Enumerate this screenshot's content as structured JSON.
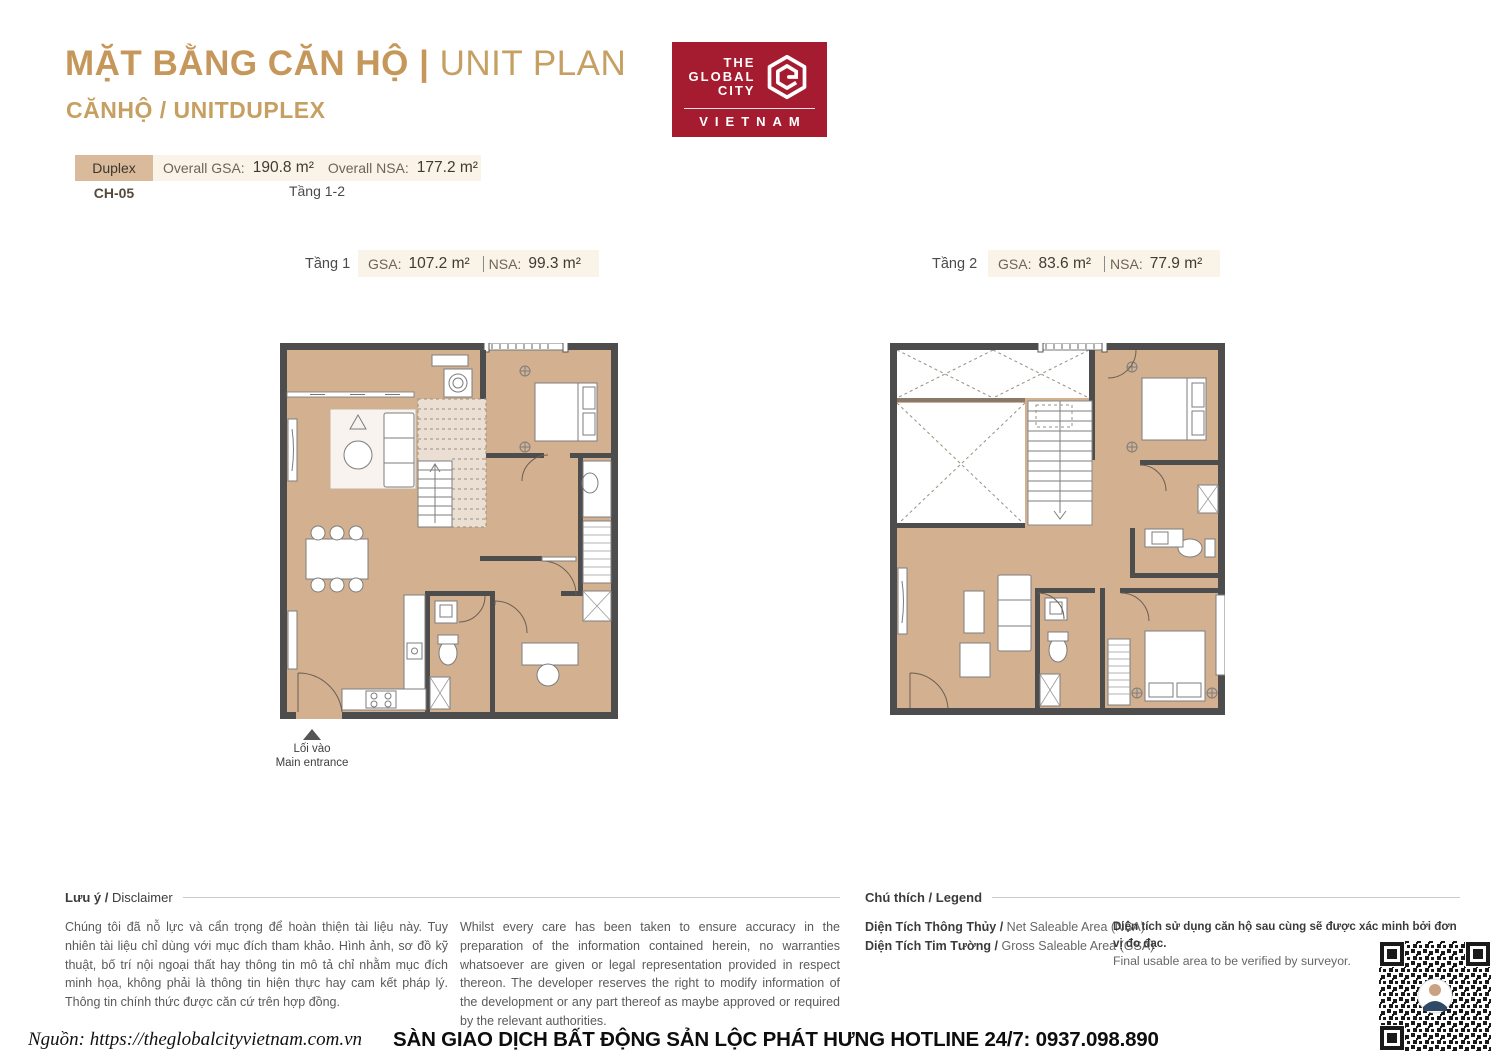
{
  "header": {
    "title_vi": "MẶT BẰNG CĂN HỘ |",
    "title_en": " UNIT PLAN",
    "subtitle": "CĂNHỘ / UNITDUPLEX",
    "logo": {
      "line1": "THE",
      "line2": "GLOBAL",
      "line3": "CITY",
      "country": "VIETNAM",
      "brand_color": "#A51C30"
    }
  },
  "summary": {
    "type_label": "Duplex",
    "gsa_label": "Overall GSA:",
    "gsa_value": "190.8 m²",
    "nsa_label": "Overall NSA:",
    "nsa_value": "177.2 m²",
    "unit_code": "CH-05",
    "floors_label": "Tầng 1-2"
  },
  "floors": [
    {
      "name": "Tầng 1",
      "gsa_label": "GSA:",
      "gsa_value": "107.2 m²",
      "nsa_label": "NSA:",
      "nsa_value": "99.3 m²"
    },
    {
      "name": "Tầng 2",
      "gsa_label": "GSA:",
      "gsa_value": "83.6 m²",
      "nsa_label": "NSA:",
      "nsa_value": "77.9 m²"
    }
  ],
  "entrance": {
    "line_vi": "Lối vào",
    "line_en": "Main entrance"
  },
  "disclaimer": {
    "heading_bold": "Lưu ý /",
    "heading_rest": " Disclaimer",
    "text_vi": "Chúng tôi đã nỗ lực và cẩn trọng để hoàn thiện tài liệu này. Tuy nhiên tài liệu chỉ dùng với mục đích tham khảo. Hình ảnh, sơ đồ kỹ thuật, bố trí nội ngoại thất hay thông tin mô tả chỉ nhằm mục đích minh họa, không phải là thông tin hiện thực hay cam kết pháp lý. Thông tin chính thức được căn cứ trên hợp đồng.",
    "text_en": "Whilst every care has been taken to ensure accuracy in the preparation of the information contained herein, no warranties whatsoever are given or legal representation provided in respect thereon. The developer reserves the right to modify information of the development or any part thereof as maybe approved or required by the relevant authorities."
  },
  "legend": {
    "heading_bold": "Chú thích /",
    "heading_rest": " Legend",
    "items": [
      {
        "vi": "Diện Tích Thông Thủy /",
        "en": " Net Saleable Area (NSA)"
      },
      {
        "vi": "Diện Tích Tim Tường /",
        "en": " Gross Saleable Area (GSA)"
      }
    ],
    "note_vi": "Diện tích sử dụng căn hộ sau cùng sẽ được xác minh bởi đơn vị đo đạc.",
    "note_en": "Final usable area to be verified by surveyor."
  },
  "footer": {
    "source": "Nguồn: https://theglobalcityvietnam.com.vn",
    "agency": "SÀN GIAO DỊCH BẤT ĐỘNG SẢN LỘC PHÁT HƯNG HOTLINE 24/7: 0937.098.890"
  },
  "colors": {
    "accent_gold": "#C6975A",
    "brand_red": "#A51C30",
    "floor_tan": "#D2B090",
    "wall_gray": "#4d4d4d",
    "panel_cream": "#FAF3E7",
    "tab_tan": "#D9BA9B"
  }
}
